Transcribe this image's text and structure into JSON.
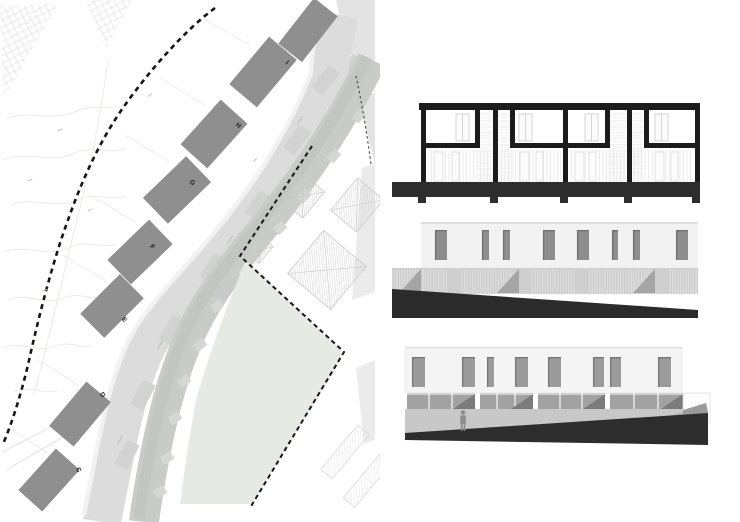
{
  "sheet": {
    "background": "#ffffff"
  },
  "site_plan": {
    "blocks": [
      {
        "label": "C"
      },
      {
        "label": "D"
      },
      {
        "label": "E"
      },
      {
        "label": "F"
      },
      {
        "label": "G"
      },
      {
        "label": "H"
      },
      {
        "label": "I"
      }
    ],
    "colors": {
      "block_fill": "#8f8f8f",
      "road": "#dcdcdc",
      "road_patch": "#d2d2d2",
      "terrace_band": "#c9cbc9",
      "terrace_teeth": "#d5d7d5",
      "green_area": "#e7eae4",
      "boundary_dash": "#161616",
      "roof_hatch": "#cdcdcd",
      "contour": "#e9e7e0"
    }
  },
  "section_drawing": {
    "colors": {
      "ink": "#1c1c1c",
      "ground": "#2d2d2d",
      "detail": "#cccccc"
    }
  },
  "elevation_upper": {
    "colors": {
      "facade": "#f2f2f2",
      "window": "#8e8e8e",
      "slat_band": "#d8d8d8",
      "shadow_wedge": "#a5a5a5",
      "ground": "#2b2b2b"
    }
  },
  "elevation_lower": {
    "colors": {
      "facade": "#f4f4f4",
      "window": "#9b9b9b",
      "glazing": "#a2a2a2",
      "shadow_triangle": "#7b7b7b",
      "terrace": "#c8c8c8",
      "ramp": "#b2b2b2",
      "ground": "#2d2d2d",
      "figure": "#8d8d8d"
    }
  }
}
